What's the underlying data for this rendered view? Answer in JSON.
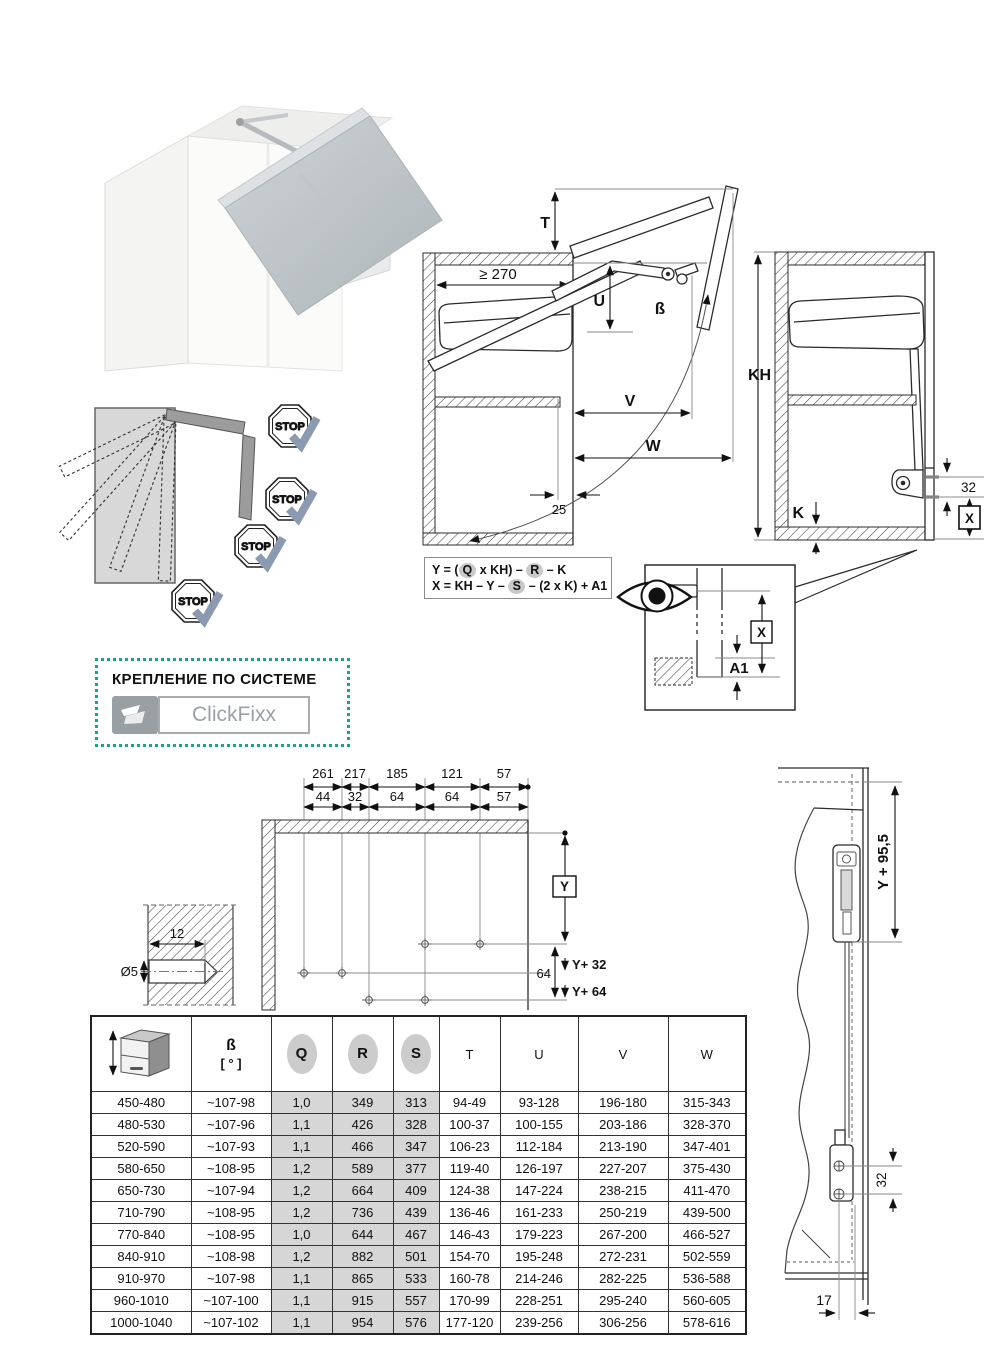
{
  "colors": {
    "accent_teal": "#14a68d",
    "table_shade": "#d6d6d6",
    "check_mark": "#8b9ab0",
    "door_gray": "#b9c1c5"
  },
  "icons": {
    "eye": "view-direction-eye-icon",
    "stop": "stop-octagon-icon",
    "check": "approval-check-icon",
    "cabinet_height": "cabinet-height-icon",
    "clickfixx": "clickfixx-flap-icon"
  },
  "open_diagram": {
    "min_depth": "≥ 270",
    "t": "T",
    "u": "U",
    "beta": "ß",
    "v": "V",
    "w": "W",
    "front_gap": "25"
  },
  "closed_diagram": {
    "kh": "KH",
    "k": "K",
    "screw_gap": "32",
    "x": "X"
  },
  "formulas": {
    "f1": {
      "pre": "Y = (",
      "q": "Q",
      "mid": " x KH) – ",
      "r": "R",
      "post": " – K"
    },
    "f2": {
      "pre": "X = KH – Y – ",
      "s": "S",
      "post": " – (2 x K) + A1"
    }
  },
  "detail_view": {
    "x": "X",
    "a1": "A1"
  },
  "stop_diagram": {
    "sign": "STOP"
  },
  "mounting": {
    "title": "КРЕПЛЕНИЕ ПО СИСТЕМЕ",
    "logo": "ClickFixx"
  },
  "drilling": {
    "row1": [
      "261",
      "217",
      "185",
      "121",
      "57"
    ],
    "row2": [
      "44",
      "32",
      "64",
      "64",
      "57"
    ],
    "y_label": "Y",
    "y32_label": "Y+ 32",
    "y64_label": "Y+ 64",
    "row_gap": "64",
    "hole_depth": "12",
    "hole_dia": "Ø5"
  },
  "side_view": {
    "top_dim": "Y + 95,5",
    "screw_gap": "32",
    "edge_dist": "17"
  },
  "table": {
    "headers": {
      "beta": "ß",
      "beta_unit": "[ ° ]",
      "q": "Q",
      "r": "R",
      "s": "S",
      "t": "T",
      "u": "U",
      "v": "V",
      "w": "W"
    },
    "rows": [
      {
        "kh": "450-480",
        "beta": "~107-98",
        "q": "1,0",
        "r": "349",
        "s": "313",
        "t": "94-49",
        "u": "93-128",
        "v": "196-180",
        "w": "315-343"
      },
      {
        "kh": "480-530",
        "beta": "~107-96",
        "q": "1,1",
        "r": "426",
        "s": "328",
        "t": "100-37",
        "u": "100-155",
        "v": "203-186",
        "w": "328-370"
      },
      {
        "kh": "520-590",
        "beta": "~107-93",
        "q": "1,1",
        "r": "466",
        "s": "347",
        "t": "106-23",
        "u": "112-184",
        "v": "213-190",
        "w": "347-401"
      },
      {
        "kh": "580-650",
        "beta": "~108-95",
        "q": "1,2",
        "r": "589",
        "s": "377",
        "t": "119-40",
        "u": "126-197",
        "v": "227-207",
        "w": "375-430"
      },
      {
        "kh": "650-730",
        "beta": "~107-94",
        "q": "1,2",
        "r": "664",
        "s": "409",
        "t": "124-38",
        "u": "147-224",
        "v": "238-215",
        "w": "411-470"
      },
      {
        "kh": "710-790",
        "beta": "~108-95",
        "q": "1,2",
        "r": "736",
        "s": "439",
        "t": "136-46",
        "u": "161-233",
        "v": "250-219",
        "w": "439-500"
      },
      {
        "kh": "770-840",
        "beta": "~108-95",
        "q": "1,0",
        "r": "644",
        "s": "467",
        "t": "146-43",
        "u": "179-223",
        "v": "267-200",
        "w": "466-527"
      },
      {
        "kh": "840-910",
        "beta": "~108-98",
        "q": "1,2",
        "r": "882",
        "s": "501",
        "t": "154-70",
        "u": "195-248",
        "v": "272-231",
        "w": "502-559"
      },
      {
        "kh": "910-970",
        "beta": "~107-98",
        "q": "1,1",
        "r": "865",
        "s": "533",
        "t": "160-78",
        "u": "214-246",
        "v": "282-225",
        "w": "536-588"
      },
      {
        "kh": "960-1010",
        "beta": "~107-100",
        "q": "1,1",
        "r": "915",
        "s": "557",
        "t": "170-99",
        "u": "228-251",
        "v": "295-240",
        "w": "560-605"
      },
      {
        "kh": "1000-1040",
        "beta": "~107-102",
        "q": "1,1",
        "r": "954",
        "s": "576",
        "t": "177-120",
        "u": "239-256",
        "v": "306-256",
        "w": "578-616"
      }
    ]
  }
}
